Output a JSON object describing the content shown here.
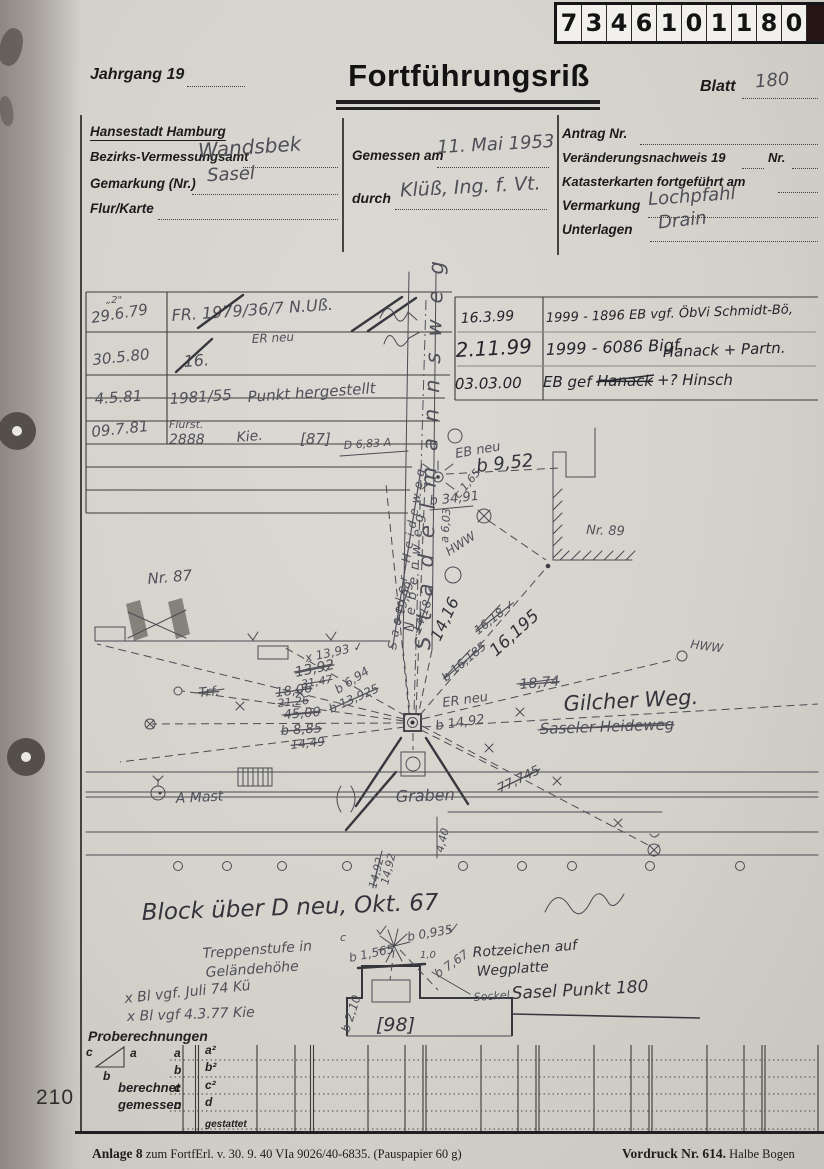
{
  "stamp": {
    "digits": [
      "7",
      "3",
      "4",
      "6",
      "1",
      "0",
      "1",
      "1",
      "8",
      "0"
    ]
  },
  "header": {
    "jahrgang": "Jahrgang 19",
    "title": "Fortführungsriß",
    "blatt": "Blatt",
    "blatt_value": "180"
  },
  "form": {
    "city": "Hansestadt Hamburg",
    "amt_label": "Bezirks-Vermessungsamt",
    "amt_value": "Wandsbek",
    "gemarkung_label": "Gemarkung (Nr.)",
    "gemarkung_value": "Sasel",
    "flur_label": "Flur/Karte",
    "gemessen_label": "Gemessen am",
    "gemessen_value": "11. Mai 1953",
    "durch_label": "durch",
    "durch_value": "Klüß, Ing. f. Vt.",
    "antrag_label": "Antrag Nr.",
    "vn_label": "Veränderungsnachweis 19",
    "vn_nr": "Nr.",
    "kk_label": "Katasterkarten fortgeführt am",
    "vermarkung_label": "Vermarkung",
    "vermarkung_value": "Lochpfahl",
    "unterlagen_label": "Unterlagen",
    "unterlagen_value": "Drain"
  },
  "log_left": {
    "note_top": "„2\"",
    "r1_date": "29.6.79",
    "r1_note": "FR. 1979/36/7 N.Uß.",
    "r2_date": "30.5.80",
    "r2_note": "16.",
    "er_neu": "ER neu",
    "r3_date": "4.5.81",
    "r3_nr": "1981/55",
    "r3_note": "Punkt hergestellt",
    "r4_flurst": "Flurst.",
    "r4_date": "09.7.81",
    "r4_nr": "2888",
    "r4_note": "Kie."
  },
  "log_right": {
    "r1_date": "16.3.99",
    "r1_note": "1999 - 1896 EB vgf. ÖbVi Schmidt-Bö,",
    "r2_date": "2.11.99",
    "r2_note": "1999 - 6086 Bigf.",
    "r2_note2": "Hanack + Partn.",
    "r3_date": "03.03.00",
    "r3_a": "EB gef",
    "r3_b": "Hanack",
    "r3_c": "+? Hinsch"
  },
  "map": {
    "street_vertical": "Stadelmannsweg",
    "heideweg_vertical": "Saseler Heideweg",
    "nebenweg": "Nebenweg",
    "nr87": "Nr. 87",
    "nr89": "Nr. 89",
    "p87": "[87]",
    "p98": "[98]",
    "d683": "D 6,83 A",
    "eb_neu": "EB neu",
    "b952": "b 9,52",
    "b3491": "b 34,91",
    "c165": "c 1,65",
    "a603": "a 6,03",
    "hww1": "HWW",
    "hww2": "HWW",
    "c1999": "c 19,99",
    "m1418": "14,18 ✓",
    "m1416": "14,16",
    "b16185": "b 16,185",
    "m1618": "16,18 ✓",
    "m16195": "16,195",
    "x1393": "x 13,93 ✓",
    "m1392": "13,92",
    "m3147": "31,47",
    "b694": "b 6,94",
    "b13925": "b 13,925",
    "trf": "Trf.",
    "m1806": "18,06",
    "m2126": "21,26",
    "m4500": "45,00",
    "b885": "b 8,85",
    "m1449": "14,49",
    "er_neu": "ER neu",
    "b1492": "b 14,92",
    "m1874": "18,74",
    "gilcher": "Gilcher Weg.",
    "heideweg_struck": "Saseler Heideweg",
    "amast": "A Mast",
    "graben": "Graben",
    "m440": "4,40",
    "m1492a": "14,92",
    "m1492b": "14,92",
    "m77745": "77,745",
    "block_note": "Block über D neu, Okt. 67",
    "treppe1": "Treppenstufe in",
    "treppe2": "Geländehöhe",
    "bl74": "x Bl vgf. Juli 74 Kü",
    "bl77": "x Bl vgf 4.3.77 Kie",
    "rotz1": "Rotzeichen auf",
    "rotz2": "Wegplatte",
    "sockel": "Sockel",
    "sasel_punkt": "Sasel Punkt 180",
    "b1565": "b 1,565",
    "b0935": "b 0,935",
    "m10": "1,0",
    "b767": "b 7,67",
    "b210": "b 2,10",
    "c_mark": "c"
  },
  "probe": {
    "title": "Proberechnungen",
    "tri_a": "a",
    "tri_b": "b",
    "tri_c": "c",
    "row_a": "a",
    "row_b": "b",
    "row_c1": "c",
    "row_c2": "c",
    "berechnet": "berechnet",
    "gemessen": "gemessen",
    "cell_a2": "a²",
    "cell_b2": "b²",
    "cell_c2": "c²",
    "cell_d": "d",
    "gestattet": "gestattet"
  },
  "page_number": "210",
  "footer": {
    "left_bold": "Anlage 8",
    "left_rest": " zum FortfErl. v. 30. 9. 40  VIa 9026/40-6835. (Pauspapier 60 g)",
    "right_bold": "Vordruck Nr. 614.",
    "right_rest": " Halbe Bogen"
  }
}
